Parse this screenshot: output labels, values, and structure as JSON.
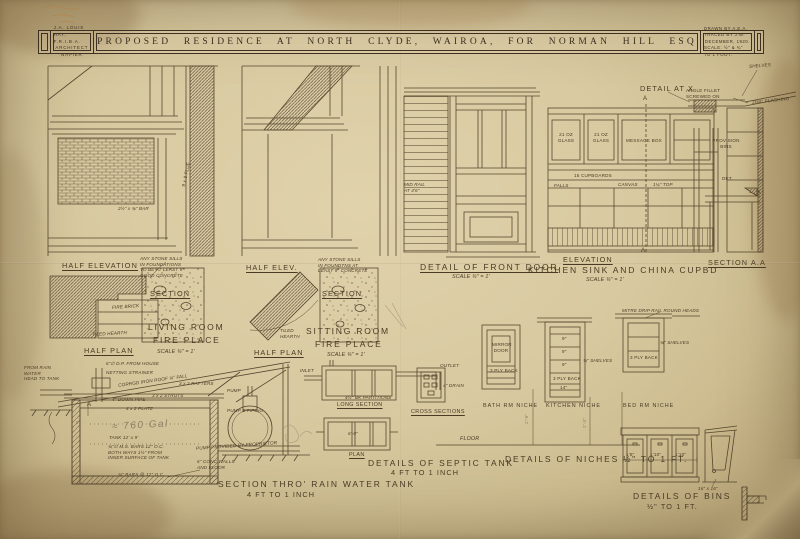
{
  "header": {
    "architect_l1": "J.A. LOUIS HAY, F.R.I.B.A.",
    "architect_l2": "ARCHITECT",
    "architect_l3": "NAPIER",
    "title": "PROPOSED RESIDENCE AT NORTH CLYDE, WAIROA, FOR NORMAN HILL ESQ",
    "drawn_l1": "DRAWN BY A.E.A.  TRACED BY J.W.",
    "drawn_l2": "DECEMBER, 1920.",
    "drawn_l3": "SCALE: ½\" & ¾\" TO 1 FOOT."
  },
  "living": {
    "half_elevation": "HALF ELEVATION",
    "stone_note": "ANY STONE SILLS\nIN FOUNDATIONS\nTO BE AT LEAST 9\"\nGOOD CONCRETE",
    "section": "SECTION",
    "fire_brick": "FIRE BRICK",
    "tiled_hearth": "TILED HEARTH",
    "half_plan": "HALF PLAN",
    "room_l1": "LIVING ROOM",
    "room_l2": "FIRE PLACE",
    "scale": "SCALE ¾\" = 1'",
    "flue": "9 x 9 FLUE",
    "bar": "2½\" x ¾\" BAR"
  },
  "sitting": {
    "half_elev": "HALF ELEV.",
    "stone_note": "ANY STONE SILLS\nIN FOUNDTNS AT\nLEAST 9\" CONCRETE",
    "section": "SECTION",
    "tiled_hearth": "TILED\nHEARTH",
    "half_plan": "HALF PLAN",
    "room_l1": "SITTING ROOM",
    "room_l2": "FIRE PLACE",
    "scale": "SCALE ¾\" = 1'"
  },
  "door": {
    "title": "DETAIL OF FRONT DOOR",
    "scale": "SCALE ¾\" = 1'",
    "mid_rail": "MID RAIL\nAT 4'6\""
  },
  "kitchen": {
    "glass_left": "21 OZ\nGLASS",
    "glass_right": "21 OZ\nGLASS",
    "message_box": "MESSAGE BOX",
    "falls": "FALLS",
    "cupboards": "15 CUPBOARDS",
    "canvas": "CANVAS",
    "top": "1¼\" TOP",
    "a_top": "A",
    "a_bottom": "A",
    "elevation": "ELEVATION",
    "title": "KITCHEN SINK AND CHINA CUPBD",
    "scale": "SCALE ¾\" = 1'"
  },
  "section_aa": {
    "title": "SECTION A.A",
    "provision": "PROVISION\nBINS",
    "det": "DET.",
    "x_marker": "X"
  },
  "detail_x": {
    "title": "DETAIL AT X",
    "shelves": "SHELVES",
    "angle_fillet": "ANGLE FILLET\nSCREWED ON",
    "zinc": "ZINC FLASHING"
  },
  "tank": {
    "dp": "6\"∅ D.P. FROM HOUSE",
    "strainer": "NETTING STRAINER",
    "roof": "CORRGD IRON ROOF ¼\" FALL",
    "rafters": "3 x 2 RAFTERS",
    "struts": "3 x 2 STRUTS",
    "downpipe": "4\" DOWN PIPE",
    "plate": "4 x 2 PLATE",
    "gal": "≈ 760 Gal",
    "tank_dim": "TANK  12' x 9'",
    "bars_note": "¾\"∅ M.S. BARS 12\" O.C.\nBOTH WAYS 1½\" FROM\nINNER SURFACE OF TANK",
    "bars2": "¾\" BARS @ 12\" O.C.",
    "conc": "6\" CONC WALLS\nAND FLOOR",
    "pump": "PUMP",
    "pump_pipe": "PUMP & PIPING",
    "pump_note": "PUMP PROVIDED BY PROPRIETOR",
    "inlet": "FROM RAIN WATER\nHEAD TO TANK",
    "dim5": "5'",
    "dim6": "6'",
    "a_marker": "A",
    "title_l1": "SECTION THRO' RAIN WATER TANK",
    "title_l2": "4 FT TO 1 INCH"
  },
  "septic": {
    "long_section": "LONG SECTION",
    "cross_sections": "CROSS SECTIONS",
    "plan": "PLAN",
    "title": "DETAILS OF SEPTIC TANK",
    "scale": "4 FT TO 1 INCH",
    "partitions": "4½\" BK PARTITIONS",
    "inlet": "INLET",
    "outlet": "OUTLET",
    "drain": "4\" DRAIN",
    "dim": "6'-0\""
  },
  "niches": {
    "bath": "BATH RM NICHE",
    "kitchen": "KITCHEN NICHE",
    "bed": "BED RM NICHE",
    "title": "DETAILS OF NICHES  ½\" TO 1 FT.",
    "mirror": "MIRROR\nDOOR",
    "ply_bath": "3 PLY BACK",
    "ply_kitchen": "3 PLY BACK",
    "ply_bed": "3 PLY BACK",
    "shelves_kitchen": "¾\" SHELVES",
    "shelves_bed": "¾\" SHELVES",
    "nine": "9\"",
    "fourteen": "14\"",
    "drip": "MITRE DRIP RAIL ROUND HEADS",
    "floor": "FLOOR",
    "dim1": "2'-9\"",
    "dim2": "2'-3\""
  },
  "bins": {
    "title": "DETAILS OF BINS",
    "scale": "½\" TO 1 FT.",
    "d1": "1'8\"",
    "d2": "1'10\"",
    "d3": "1'10\"",
    "size": "16\" x 16\""
  }
}
